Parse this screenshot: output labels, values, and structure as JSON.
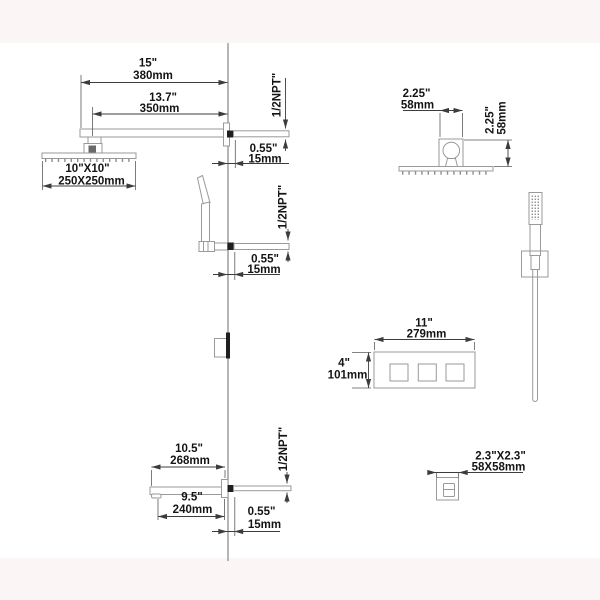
{
  "colors": {
    "background": "#ffffff",
    "margin_band": "#fcf5f5",
    "product_outline": "#9a9a9a",
    "dimension_line": "#3c3c3c",
    "text": "#141414",
    "wall_fitting_fill": "#1f1f1f"
  },
  "views": {
    "rain_head_side": {
      "arm_length_in": "15\"",
      "arm_length_mm": "380mm",
      "head_offset_in": "13.7\"",
      "head_offset_mm": "350mm",
      "head_size_in": "10\"X10\"",
      "head_size_mm": "250X250mm",
      "thread": "1/2NPT\"",
      "wall_nipple_in": "0.55\"",
      "wall_nipple_mm": "15mm"
    },
    "hand_shower_side": {
      "thread": "1/2NPT\"",
      "wall_nipple_in": "0.55\"",
      "wall_nipple_mm": "15mm"
    },
    "rain_head_top": {
      "arm_width_in": "2.25\"",
      "arm_width_mm": "58mm",
      "arm_depth_in": "2.25\"",
      "arm_depth_mm": "58mm"
    },
    "valve_front": {
      "width_in": "11\"",
      "width_mm": "279mm",
      "height_in": "4\"",
      "height_mm": "101mm"
    },
    "tub_spout_side": {
      "reach_in": "10.5\"",
      "reach_mm": "268mm",
      "body_in": "9.5\"",
      "body_mm": "240mm",
      "thread": "1/2NPT\"",
      "wall_nipple_in": "0.55\"",
      "wall_nipple_mm": "15mm"
    },
    "spout_front": {
      "size_in": "2.3\"X2.3\"",
      "size_mm": "58X58mm"
    }
  }
}
